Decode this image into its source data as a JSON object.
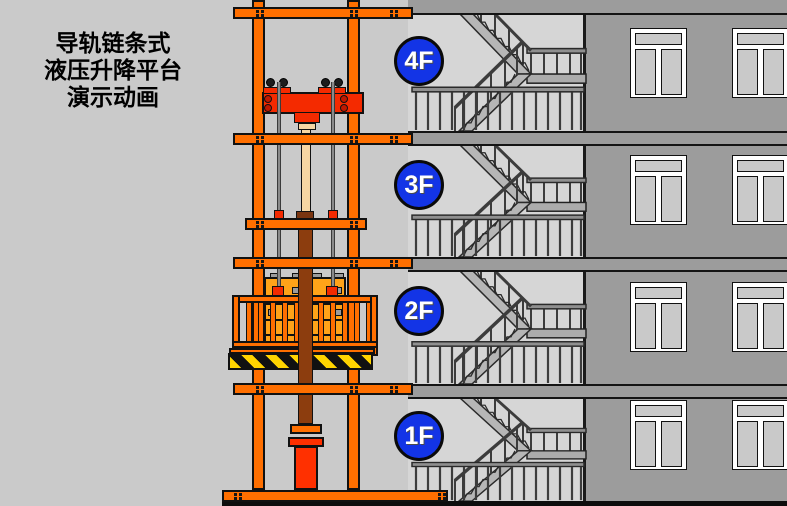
{
  "title": {
    "lines": [
      "导轨链条式",
      "液压升降平台",
      "演示动画"
    ]
  },
  "floors": [
    {
      "label": "4F"
    },
    {
      "label": "3F"
    },
    {
      "label": "2F"
    },
    {
      "label": "1F"
    }
  ],
  "colors": {
    "orange": "#FF6F00",
    "red": "#F42A00",
    "bright_red": "#FF3000",
    "brown": "#8C3D0E",
    "dark_brown": "#7A3510",
    "beige": "#F6D6A3",
    "cargo_orange": "#FFA319",
    "hazard_yellow": "#FFD400",
    "floor_blue": "#1334E6",
    "wall_gray": "#9C9C9C",
    "interior_gray": "#D6D6D6",
    "stair_gray": "#B6B6B6",
    "background_gray": "#CACACA",
    "ground_black": "#0D0D0D"
  }
}
